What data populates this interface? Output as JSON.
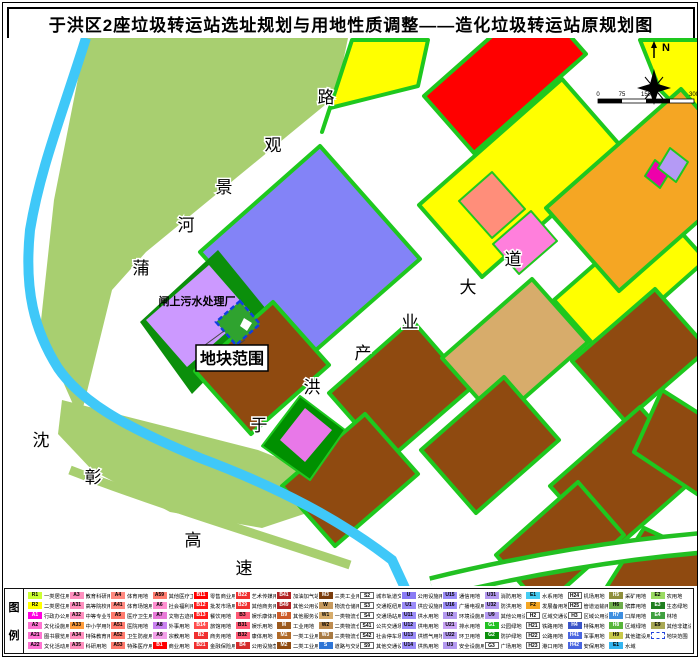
{
  "title": "于洪区2座垃圾转运站选址规划与用地性质调整——造化垃圾转运站原规划图",
  "map": {
    "labels": {
      "plant": "闸上污水处理厂",
      "callout": "地块范围",
      "north": "N"
    },
    "road_labels": [
      {
        "name": "puhe-jingguan-road",
        "chars": [
          "蒲",
          "河",
          "景",
          "观",
          "路"
        ],
        "pos": [
          [
            141,
            274
          ],
          [
            186,
            231
          ],
          [
            224,
            193
          ],
          [
            273,
            151
          ],
          [
            326,
            103
          ]
        ]
      },
      {
        "name": "yuhong-chanye-avenue",
        "chars": [
          "于",
          "洪",
          "产",
          "业",
          "大",
          "道"
        ],
        "pos": [
          [
            259,
            431
          ],
          [
            312,
            393
          ],
          [
            363,
            359
          ],
          [
            410,
            328
          ],
          [
            468,
            293
          ],
          [
            513,
            265
          ]
        ]
      },
      {
        "name": "shenzhang-expressway",
        "chars": [
          "沈",
          "彰",
          "高",
          "速"
        ],
        "pos": [
          [
            41,
            446
          ],
          [
            93,
            483
          ],
          [
            193,
            546
          ],
          [
            244,
            574
          ]
        ]
      }
    ],
    "scale_ticks": [
      "0",
      "75",
      "150",
      "300"
    ],
    "colors": {
      "residential_yellow": "#FFFF00",
      "commercial_red": "#FF0000",
      "industrial_brown": "#8F4A10",
      "logistics_tan": "#D7AC6B",
      "utility_violet": "#8383F7",
      "sewage_purple": "#CC99FF",
      "greenbelt": "#1EC81E",
      "riverside_green": "#A8CF70",
      "river_cyan": "#3FC8F8",
      "site_green": "#2FA32F",
      "site_outline_blue": "#1040E0",
      "orange": "#F5A623"
    }
  },
  "legend": {
    "panel_label": [
      "图",
      "例"
    ],
    "items": [
      {
        "code": "R1",
        "name": "一类居住用地",
        "fill": "#CCFF33"
      },
      {
        "code": "R2",
        "name": "二类居住用地",
        "fill": "#FFFF00"
      },
      {
        "code": "A1",
        "name": "行政办公用地",
        "fill": "#FF00E0"
      },
      {
        "code": "A2",
        "name": "文化设施用地",
        "fill": "#FF73D2"
      },
      {
        "code": "A21",
        "name": "图书展览用地",
        "fill": "#FF73D2"
      },
      {
        "code": "A22",
        "name": "文化活动用地",
        "fill": "#FF73D2"
      },
      {
        "code": "A3",
        "name": "教育科研用地",
        "fill": "#FF8FBE"
      },
      {
        "code": "A31",
        "name": "高等院校用地",
        "fill": "#FF8FBE"
      },
      {
        "code": "A32",
        "name": "中等专业学校用地",
        "fill": "#FF8FBE"
      },
      {
        "code": "A33",
        "name": "中小学用地",
        "fill": "#FF9D3C"
      },
      {
        "code": "A34",
        "name": "特殊教育用地",
        "fill": "#FF8FBE"
      },
      {
        "code": "A35",
        "name": "科研用地",
        "fill": "#FF8FBE"
      },
      {
        "code": "A4",
        "name": "体育用地",
        "fill": "#FF8A80"
      },
      {
        "code": "A41",
        "name": "体育场馆用地",
        "fill": "#FF8A80"
      },
      {
        "code": "A5",
        "name": "医疗卫生用地",
        "fill": "#FF7B6E"
      },
      {
        "code": "A51",
        "name": "医院用地",
        "fill": "#FF7B6E"
      },
      {
        "code": "A52",
        "name": "卫生防疫用地",
        "fill": "#FF7B6E"
      },
      {
        "code": "A53",
        "name": "特殊医疗用地",
        "fill": "#FF7B6E"
      },
      {
        "code": "A59",
        "name": "其他医疗卫生用地",
        "fill": "#FF7B6E"
      },
      {
        "code": "A6",
        "name": "社会福利用地",
        "fill": "#FF8FD0"
      },
      {
        "code": "A7",
        "name": "文物古迹用地",
        "fill": "#E87BD8"
      },
      {
        "code": "A8",
        "name": "外事用地",
        "fill": "#C983F0"
      },
      {
        "code": "A9",
        "name": "宗教用地",
        "fill": "#F2A0E8"
      },
      {
        "code": "B1",
        "name": "商业用地",
        "fill": "#FF0000"
      },
      {
        "code": "B11",
        "name": "零售商业用地",
        "fill": "#FF0000"
      },
      {
        "code": "B12",
        "name": "批发市场用地",
        "fill": "#FF1A1A"
      },
      {
        "code": "B13",
        "name": "餐饮用地",
        "fill": "#FF1A1A"
      },
      {
        "code": "B14",
        "name": "旅馆用地",
        "fill": "#FF4D4D"
      },
      {
        "code": "B2",
        "name": "商务用地",
        "fill": "#F03030"
      },
      {
        "code": "B21",
        "name": "金融保险用地",
        "fill": "#F03030"
      },
      {
        "code": "B22",
        "name": "艺术传媒用地",
        "fill": "#F03030"
      },
      {
        "code": "B29",
        "name": "其他商务用地",
        "fill": "#F03030"
      },
      {
        "code": "B3",
        "name": "娱乐康体用地",
        "fill": "#FF5A76"
      },
      {
        "code": "B31",
        "name": "娱乐用地",
        "fill": "#FF5A76"
      },
      {
        "code": "B32",
        "name": "康体用地",
        "fill": "#FF5A76"
      },
      {
        "code": "B4",
        "name": "公用设施营业网点用地",
        "fill": "#D42A2A"
      },
      {
        "code": "B41",
        "name": "加油加气站用地",
        "fill": "#B22222"
      },
      {
        "code": "B49",
        "name": "其他公用设施营业网点用地",
        "fill": "#B22222"
      },
      {
        "code": "B9",
        "name": "其他服务设施用地",
        "fill": "#CD5C2A"
      },
      {
        "code": "M",
        "name": "工业用地",
        "fill": "#9C5A1E"
      },
      {
        "code": "M1",
        "name": "一类工业用地",
        "fill": "#B06A28"
      },
      {
        "code": "M2",
        "name": "二类工业用地",
        "fill": "#8F4A10"
      },
      {
        "code": "M3",
        "name": "三类工业用地",
        "fill": "#7A3C0C"
      },
      {
        "code": "W",
        "name": "物流仓储用地",
        "fill": "#C79A5E"
      },
      {
        "code": "W1",
        "name": "一类物流仓储用地",
        "fill": "#D7AC6B"
      },
      {
        "code": "W2",
        "name": "二类物流仓储用地",
        "fill": "#BE8C50"
      },
      {
        "code": "W3",
        "name": "三类物流仓储用地",
        "fill": "#A87A42"
      },
      {
        "code": "S",
        "name": "道路与交通设施用地",
        "fill": "#2E75D6"
      },
      {
        "code": "S2",
        "name": "城市轨道交通用地",
        "fill": "#FFFFFF"
      },
      {
        "code": "S3",
        "name": "交通枢纽用地",
        "fill": "#FFFFFF"
      },
      {
        "code": "S4",
        "name": "交通场站用地",
        "fill": "#FFFFFF"
      },
      {
        "code": "S41",
        "name": "公共交通场站用地",
        "fill": "#FFFFFF"
      },
      {
        "code": "S42",
        "name": "社会停车场用地",
        "fill": "#FFFFFF"
      },
      {
        "code": "S9",
        "name": "其他交通设施用地",
        "fill": "#FFFFFF"
      },
      {
        "code": "U",
        "name": "公用设施用地",
        "fill": "#8A7CF5"
      },
      {
        "code": "U1",
        "name": "供应设施用地",
        "fill": "#9B8CF8"
      },
      {
        "code": "U11",
        "name": "供水用地",
        "fill": "#9B8CF8"
      },
      {
        "code": "U12",
        "name": "供电用地",
        "fill": "#9B8CF8"
      },
      {
        "code": "U13",
        "name": "供燃气用地",
        "fill": "#9B8CF8"
      },
      {
        "code": "U14",
        "name": "供热用地",
        "fill": "#9B8CF8"
      },
      {
        "code": "U15",
        "name": "通信用地",
        "fill": "#9B8CF8"
      },
      {
        "code": "U16",
        "name": "广播电视用地",
        "fill": "#9B8CF8"
      },
      {
        "code": "U2",
        "name": "环境设施用地",
        "fill": "#B49AF0"
      },
      {
        "code": "U21",
        "name": "排水用地",
        "fill": "#C9A3F5"
      },
      {
        "code": "U22",
        "name": "环卫用地",
        "fill": "#B49AF0"
      },
      {
        "code": "U3",
        "name": "安全设施用地",
        "fill": "#B49AF0"
      },
      {
        "code": "U31",
        "name": "消防用地",
        "fill": "#B49AF0"
      },
      {
        "code": "U32",
        "name": "防洪用地",
        "fill": "#B49AF0"
      },
      {
        "code": "U9",
        "name": "其他公用设施用地",
        "fill": "#B49AF0"
      },
      {
        "code": "G1",
        "name": "公园绿地",
        "fill": "#22C022"
      },
      {
        "code": "G2",
        "name": "防护绿地",
        "fill": "#0B8F0B"
      },
      {
        "code": "G3",
        "name": "广场用地",
        "fill": "#FFFFFF"
      },
      {
        "code": "E1",
        "name": "水系用地",
        "fill": "#45CCF2"
      },
      {
        "code": "F2",
        "name": "发展备用地",
        "fill": "#F5A623"
      },
      {
        "code": "H2",
        "name": "区域交通设施用地",
        "fill": "#FFFFFF"
      },
      {
        "code": "H21",
        "name": "铁路用地",
        "fill": "#FFFFFF"
      },
      {
        "code": "H22",
        "name": "公路用地",
        "fill": "#FFFFFF"
      },
      {
        "code": "H23",
        "name": "港口用地",
        "fill": "#FFFFFF"
      },
      {
        "code": "H24",
        "name": "机场用地",
        "fill": "#FFFFFF"
      },
      {
        "code": "H25",
        "name": "管道运输用地",
        "fill": "#FFFFFF"
      },
      {
        "code": "H3",
        "name": "区域公用设施用地",
        "fill": "#FFFFFF"
      },
      {
        "code": "H4",
        "name": "特殊用地",
        "fill": "#3B55C8"
      },
      {
        "code": "H41",
        "name": "军事用地",
        "fill": "#4A66E0"
      },
      {
        "code": "H42",
        "name": "安保用地",
        "fill": "#4A66E0"
      },
      {
        "code": "H5",
        "name": "采矿用地",
        "fill": "#8F8F3C"
      },
      {
        "code": "H6",
        "name": "殡葬用地",
        "fill": "#6FAE4C"
      },
      {
        "code": "H7",
        "name": "口岸用地",
        "fill": "#3E8EE0"
      },
      {
        "code": "H8",
        "name": "区域绿地",
        "fill": "#57B53A"
      },
      {
        "code": "H9",
        "name": "其他建设用地",
        "fill": "#C9C94A"
      },
      {
        "code": "E1",
        "name": "水域",
        "fill": "#35B5F0"
      },
      {
        "code": "E2",
        "name": "农用地",
        "fill": "#9ADB63"
      },
      {
        "code": "E3",
        "name": "生态绿地",
        "fill": "#1E7E1E"
      },
      {
        "code": "E4",
        "name": "林地",
        "fill": "#3FA03F"
      },
      {
        "code": "E9",
        "name": "其他非建设用地",
        "fill": "#A8A855"
      },
      {
        "code": "",
        "name": "地块范围",
        "fill": "#FFFFFF",
        "dashed": true
      }
    ]
  }
}
